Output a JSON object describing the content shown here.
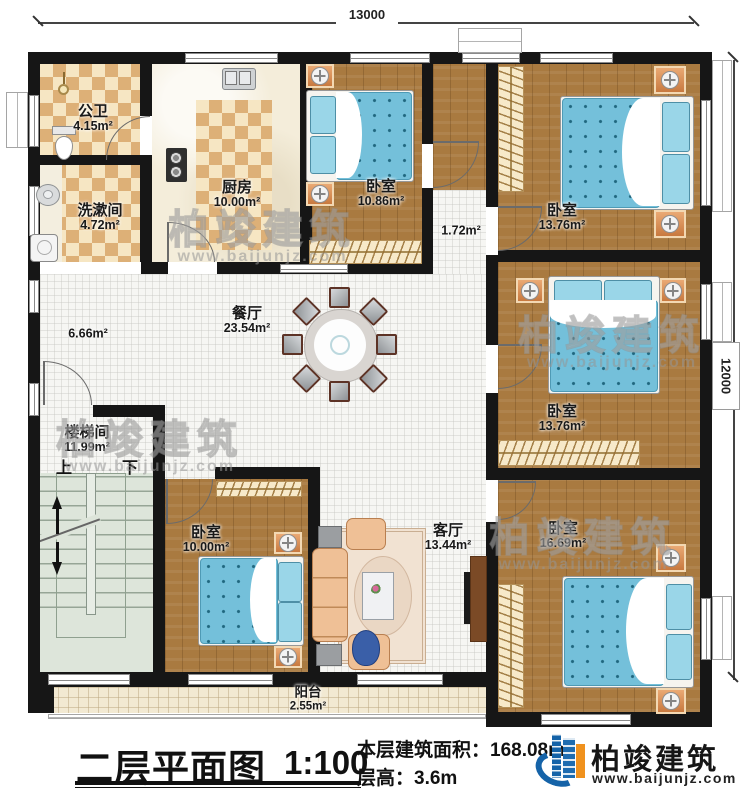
{
  "dimensions": {
    "top": "13000",
    "right": "12000"
  },
  "rooms": {
    "gongwei": {
      "name": "公卫",
      "area": "4.15m²"
    },
    "xishujian": {
      "name": "洗漱间",
      "area": "4.72m²"
    },
    "chufang": {
      "name": "厨房",
      "area": "10.00m²"
    },
    "woshi_top": {
      "name": "卧室",
      "area": "10.86m²"
    },
    "corridor": {
      "area": "1.72m²"
    },
    "woshi_topright": {
      "name": "卧室",
      "area": "13.76m²"
    },
    "canting": {
      "name": "餐厅",
      "area": "23.54m²"
    },
    "hall": {
      "area": "6.66m²"
    },
    "loutijian": {
      "name": "楼梯间",
      "area": "11.99m²"
    },
    "stairs": {
      "up": "上",
      "down": "下"
    },
    "woshi_midright": {
      "name": "卧室",
      "area": "13.76m²"
    },
    "woshi_botleft": {
      "name": "卧室",
      "area": "10.00m²"
    },
    "keting": {
      "name": "客厅",
      "area": "13.44m²"
    },
    "woshi_botright": {
      "name": "卧室",
      "area": "16.69m²"
    },
    "yangtai": {
      "name": "阳台",
      "area": "2.55m²"
    }
  },
  "title_block": {
    "title": "二层平面图",
    "scale": "1:100",
    "area_label": "本层建筑面积：",
    "area_value": "168.08m²",
    "height_label": "层高：",
    "height_value": "3.6m"
  },
  "brand": {
    "name": "柏竣建筑",
    "site": "www.baijunjz.com"
  }
}
